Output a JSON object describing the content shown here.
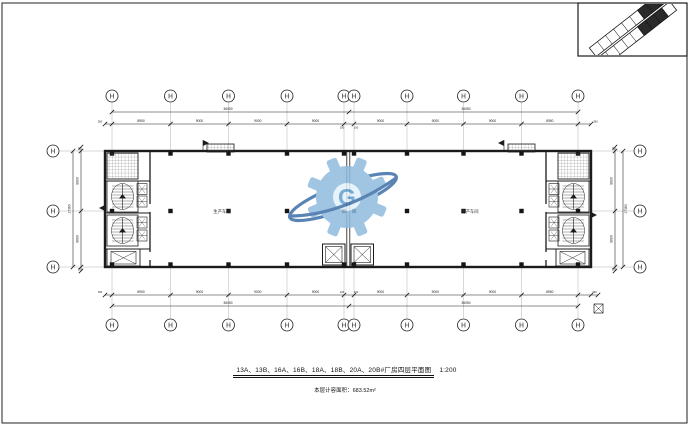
{
  "drawing": {
    "title": "13A、13B、16A、16B、18A、18B、20A、20B#厂房四层平面图",
    "scale": "1:200",
    "area_note": "本层计容面积：683.52m²",
    "room_label_left": "生产车间",
    "room_label_right": "生产车间"
  },
  "dimensions": {
    "top": {
      "segments": [
        "8950",
        "9000",
        "9000",
        "9000",
        "9000",
        "9000",
        "9000",
        "8950"
      ],
      "overall_left": "36050",
      "overall_right": "36050",
      "joint_left": "100",
      "joint_right": "100",
      "edge_left": "360",
      "edge_right": "360"
    },
    "bottom": {
      "segments": [
        "8950",
        "9000",
        "9000",
        "9000",
        "9000",
        "9000",
        "9000",
        "8950"
      ],
      "overall_left": "36050",
      "overall_right": "36050",
      "joint_left": "100",
      "joint_right": "100",
      "edge_left": "360",
      "edge_right": "360"
    },
    "left": {
      "segments": [
        "8680",
        "8680"
      ],
      "overall": "17360",
      "edge_top": "50",
      "edge_bottom": "50"
    },
    "right": {
      "segments": [
        "8680",
        "8680"
      ],
      "overall": "17360",
      "edge_top": "50",
      "edge_bottom": "50"
    }
  },
  "watermark": {
    "letter": "G"
  },
  "colors": {
    "line": "#1b1b1b",
    "grid": "#b0b0b0",
    "watermark_gear": "#8fbcdf",
    "watermark_hole": "#e3f0fa",
    "watermark_ring": "#3e6fa8",
    "watermark_letter": "#5f9fcf"
  }
}
